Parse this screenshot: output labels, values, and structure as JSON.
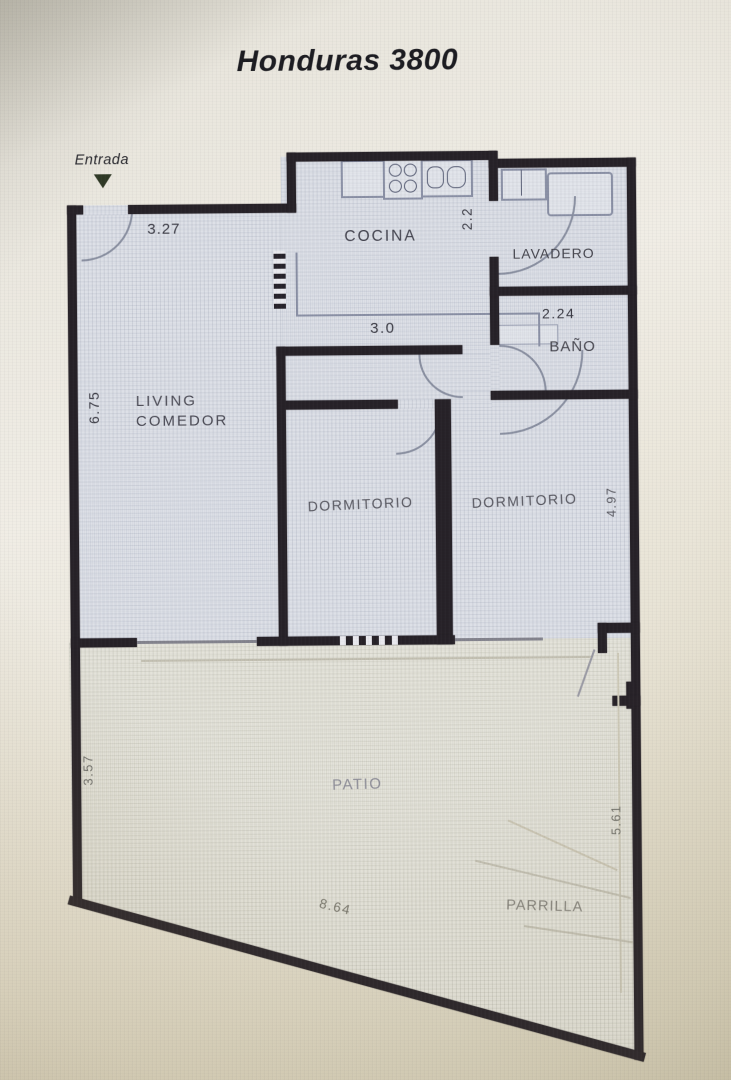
{
  "title": "Honduras 3800",
  "entrance": {
    "label": "Entrada"
  },
  "rooms": {
    "cocina": "COCINA",
    "lavadero": "LAVADERO",
    "bano": "BAÑO",
    "living_line1": "LIVING",
    "living_line2": "COMEDOR",
    "dormitorio1": "DORMITORIO",
    "dormitorio2": "DORMITORIO",
    "patio": "PATIO",
    "parrilla": "PARRILLA"
  },
  "dimensions": {
    "entry_width": "3.27",
    "cocina_depth": "2.2",
    "cocina_width": "3.0",
    "bano_width": "2.24",
    "living_length": "6.75",
    "dormitorio_depth": "4.97",
    "patio_left_side": "3.57",
    "patio_right_side": "5.61",
    "patio_bottom": "8.64"
  },
  "colors": {
    "wall": "#262127",
    "interior_floor": "#dde0e7",
    "patio_floor": "#e4e3da",
    "photo_background": "#eae7dc",
    "label_dark": "#46464f",
    "label_muted": "#85837b",
    "entrance_arrow": "#2e3824",
    "fixture_outline": "#8a90a6"
  }
}
